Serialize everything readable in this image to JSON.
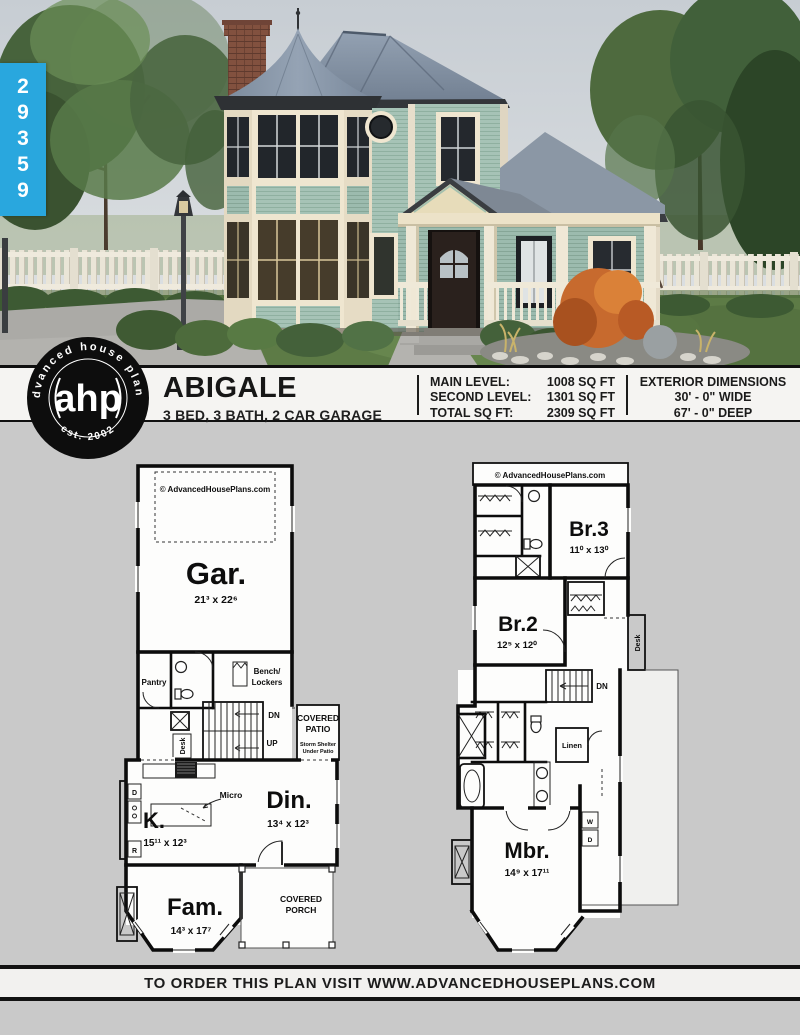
{
  "plan_tab": {
    "number": "29359"
  },
  "header": {
    "logo": {
      "center": "ahp",
      "arc_top": "advanced house plans",
      "arc_bottom": "est. 2002"
    },
    "title": "ABIGALE",
    "subtitle": "3 BED, 3 BATH, 2 CAR GARAGE",
    "specs": [
      {
        "label": "MAIN LEVEL:",
        "value": "1008 SQ FT"
      },
      {
        "label": "SECOND LEVEL:",
        "value": "1301 SQ FT"
      },
      {
        "label": "TOTAL SQ FT:",
        "value": "2309 SQ FT"
      }
    ],
    "exterior": {
      "heading": "EXTERIOR DIMENSIONS",
      "width": "30' - 0\" WIDE",
      "depth": "67' - 0\" DEEP"
    }
  },
  "plans": {
    "main_level": {
      "watermark": "© AdvancedHousePlans.com",
      "garage": {
        "label": "Gar.",
        "dims": "21³ x 22⁶"
      },
      "pantry": "Pantry",
      "bench1": "Bench/",
      "bench2": "Lockers",
      "desk": "Desk",
      "dn": "DN",
      "up": "UP",
      "patio1": "COVERED",
      "patio2": "PATIO",
      "patio_note1": "Storm Shelter",
      "patio_note2": "Under Patio",
      "kitchen": {
        "label": "K.",
        "dims": "15¹¹ x 12³"
      },
      "micro": "Micro",
      "dining": {
        "label": "Din.",
        "dims": "13⁴ x 12³"
      },
      "family": {
        "label": "Fam.",
        "dims": "14³ x 17⁷"
      },
      "porch1": "COVERED",
      "porch2": "PORCH",
      "d": "D",
      "r": "R"
    },
    "second_level": {
      "watermark": "© AdvancedHousePlans.com",
      "br3": {
        "label": "Br.3",
        "dims": "11⁰ x 13⁰"
      },
      "br2": {
        "label": "Br.2",
        "dims": "12⁵ x 12⁰"
      },
      "mbr": {
        "label": "Mbr.",
        "dims": "14⁹ x 17¹¹"
      },
      "linen": "Linen",
      "desk": "Desk",
      "dn": "DN",
      "w": "W",
      "d": "D"
    }
  },
  "footer": {
    "text": "TO ORDER THIS PLAN VISIT WWW.ADVANCEDHOUSEPLANS.COM"
  },
  "colors": {
    "brand_blue": "#29a7de",
    "background_gray": "#c9c9c9",
    "siding_green": "#a6c3b6",
    "roof_gray": "#8492a4",
    "trim_cream": "#efe6d0",
    "door_brown": "#2a211d",
    "lawn_green": "#5d7b46",
    "orange_bush": "#c76a2e",
    "sky_gray": "#c7cdd3"
  }
}
